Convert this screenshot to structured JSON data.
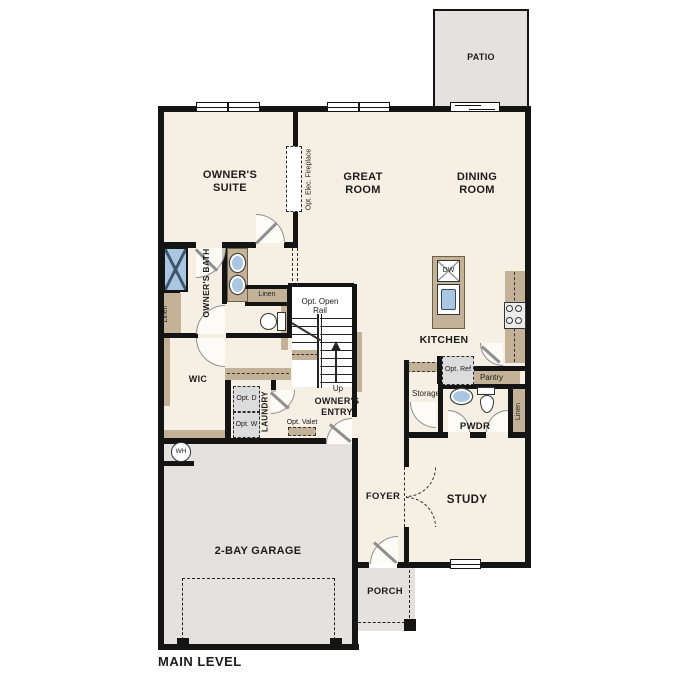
{
  "plan_title": "MAIN LEVEL",
  "rooms": {
    "patio": "PATIO",
    "owners_suite": "OWNER'S SUITE",
    "great_room": "GREAT ROOM",
    "dining_room": "DINING ROOM",
    "kitchen": "KITCHEN",
    "owners_bath": "OWNER'S BATH",
    "wic": "WIC",
    "laundry": "LAUNDRY",
    "owners_entry": "OWNER'S ENTRY",
    "pwdr": "PWDR",
    "storage": "Storage",
    "pantry": "Pantry",
    "study": "STUDY",
    "foyer": "FOYER",
    "porch": "PORCH",
    "garage": "2-BAY GARAGE"
  },
  "closets": {
    "linen_bath": "Linen",
    "linen_hall": "Linen",
    "linen_pwdr": "Linen"
  },
  "annotations": {
    "opt_elec_fireplace": "Opt. Elec. Fireplace",
    "opt_open_rail": "Opt. Open Rail",
    "up": "Up",
    "opt_dryer": "Opt. D",
    "opt_washer": "Opt. W",
    "opt_valet": "Opt. Valet",
    "opt_ref": "Opt. Ref",
    "dishwasher": "DW",
    "water_heater": "WH"
  },
  "colors": {
    "floor": "#f6efe3",
    "outdoor": "#e3e2df",
    "wall": "#141414",
    "cabinet": "#c3b297",
    "fixture_blue": "#a9c6e3",
    "appliance_gray": "#dcdcdc"
  }
}
